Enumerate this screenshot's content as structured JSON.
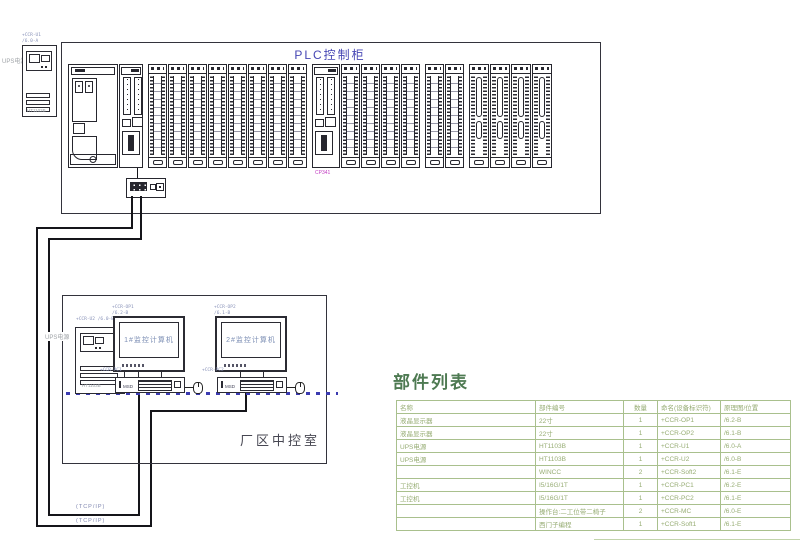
{
  "window": {
    "width": 800,
    "height": 543
  },
  "colors": {
    "line": "#2b2b33",
    "blue_title": "#4646b4",
    "screen_text": "#7d8fb5",
    "annotation": "#8892b8",
    "gray_label": "#a0a4a8",
    "room_text": "#474752",
    "table_border": "#a9c08d",
    "table_text": "#97ad74",
    "table_title": "#4e7a52",
    "magenta": "#c23cc2",
    "cable": "#15151a",
    "bus": "#3b3bb0"
  },
  "plc_cabinet": {
    "title": "PLC控制柜"
  },
  "rack": {
    "layout": [
      "psu",
      "cpu",
      "gap",
      "io",
      "io",
      "io",
      "io",
      "io",
      "io",
      "io",
      "io",
      "gap",
      "cp",
      "io",
      "io",
      "io",
      "io",
      "gap",
      "io",
      "io",
      "gap",
      "an",
      "an",
      "an",
      "an"
    ],
    "cp_label": "CP341"
  },
  "ups_main": {
    "label": "UPS电源",
    "tag": "+CCR-U1",
    "loc": "/6.0-A",
    "model": "HT1103B"
  },
  "control_room": {
    "label": "厂区中控室",
    "ups": {
      "label": "UPS电源",
      "tag": "+CCR-U2",
      "loc": "/6.0-B",
      "model": "HT1103B"
    },
    "monitors": [
      {
        "name": "1#监控计算机",
        "tag": "+CCR-OP1",
        "loc": "/6.2-B"
      },
      {
        "name": "2#监控计算机",
        "tag": "+CCR-OP2",
        "loc": "/6.1-B"
      }
    ],
    "pcs": [
      {
        "tag": "+CCR-PC1",
        "loc": "/6.2-E",
        "badge": "MSD"
      },
      {
        "tag": "+CCR-PC2",
        "loc": "/6.1-E",
        "badge": "MSD"
      }
    ]
  },
  "network": {
    "tcp_label_1": "(TCP/IP)",
    "tcp_label_2": "(TCP/IP)"
  },
  "parts_table": {
    "title": "部件列表",
    "headers": [
      "名称",
      "部件编号",
      "数量",
      "命名(设备标识符)",
      "原理图/位置"
    ],
    "rows": [
      [
        "液晶显示器",
        "22寸",
        "1",
        "+CCR-OP1",
        "/6.2-B"
      ],
      [
        "液晶显示器",
        "22寸",
        "1",
        "+CCR-OP2",
        "/6.1-B"
      ],
      [
        "UPS电源",
        "HT1103B",
        "1",
        "+CCR-U1",
        "/6.0-A"
      ],
      [
        "UPS电源",
        "HT1103B",
        "1",
        "+CCR-U2",
        "/6.0-B"
      ],
      [
        "",
        "WINCC",
        "2",
        "+CCR-Soft2",
        "/6.1-E"
      ],
      [
        "工控机",
        "I5/16G/1T",
        "1",
        "+CCR-PC1",
        "/6.2-E"
      ],
      [
        "工控机",
        "I5/16G/1T",
        "1",
        "+CCR-PC2",
        "/6.1-E"
      ],
      [
        "",
        "操作台:二工位带二椅子",
        "2",
        "+CCR-MC",
        "/6.0-E"
      ],
      [
        "",
        "西门子编程",
        "1",
        "+CCR-Soft1",
        "/6.1-E"
      ]
    ]
  }
}
